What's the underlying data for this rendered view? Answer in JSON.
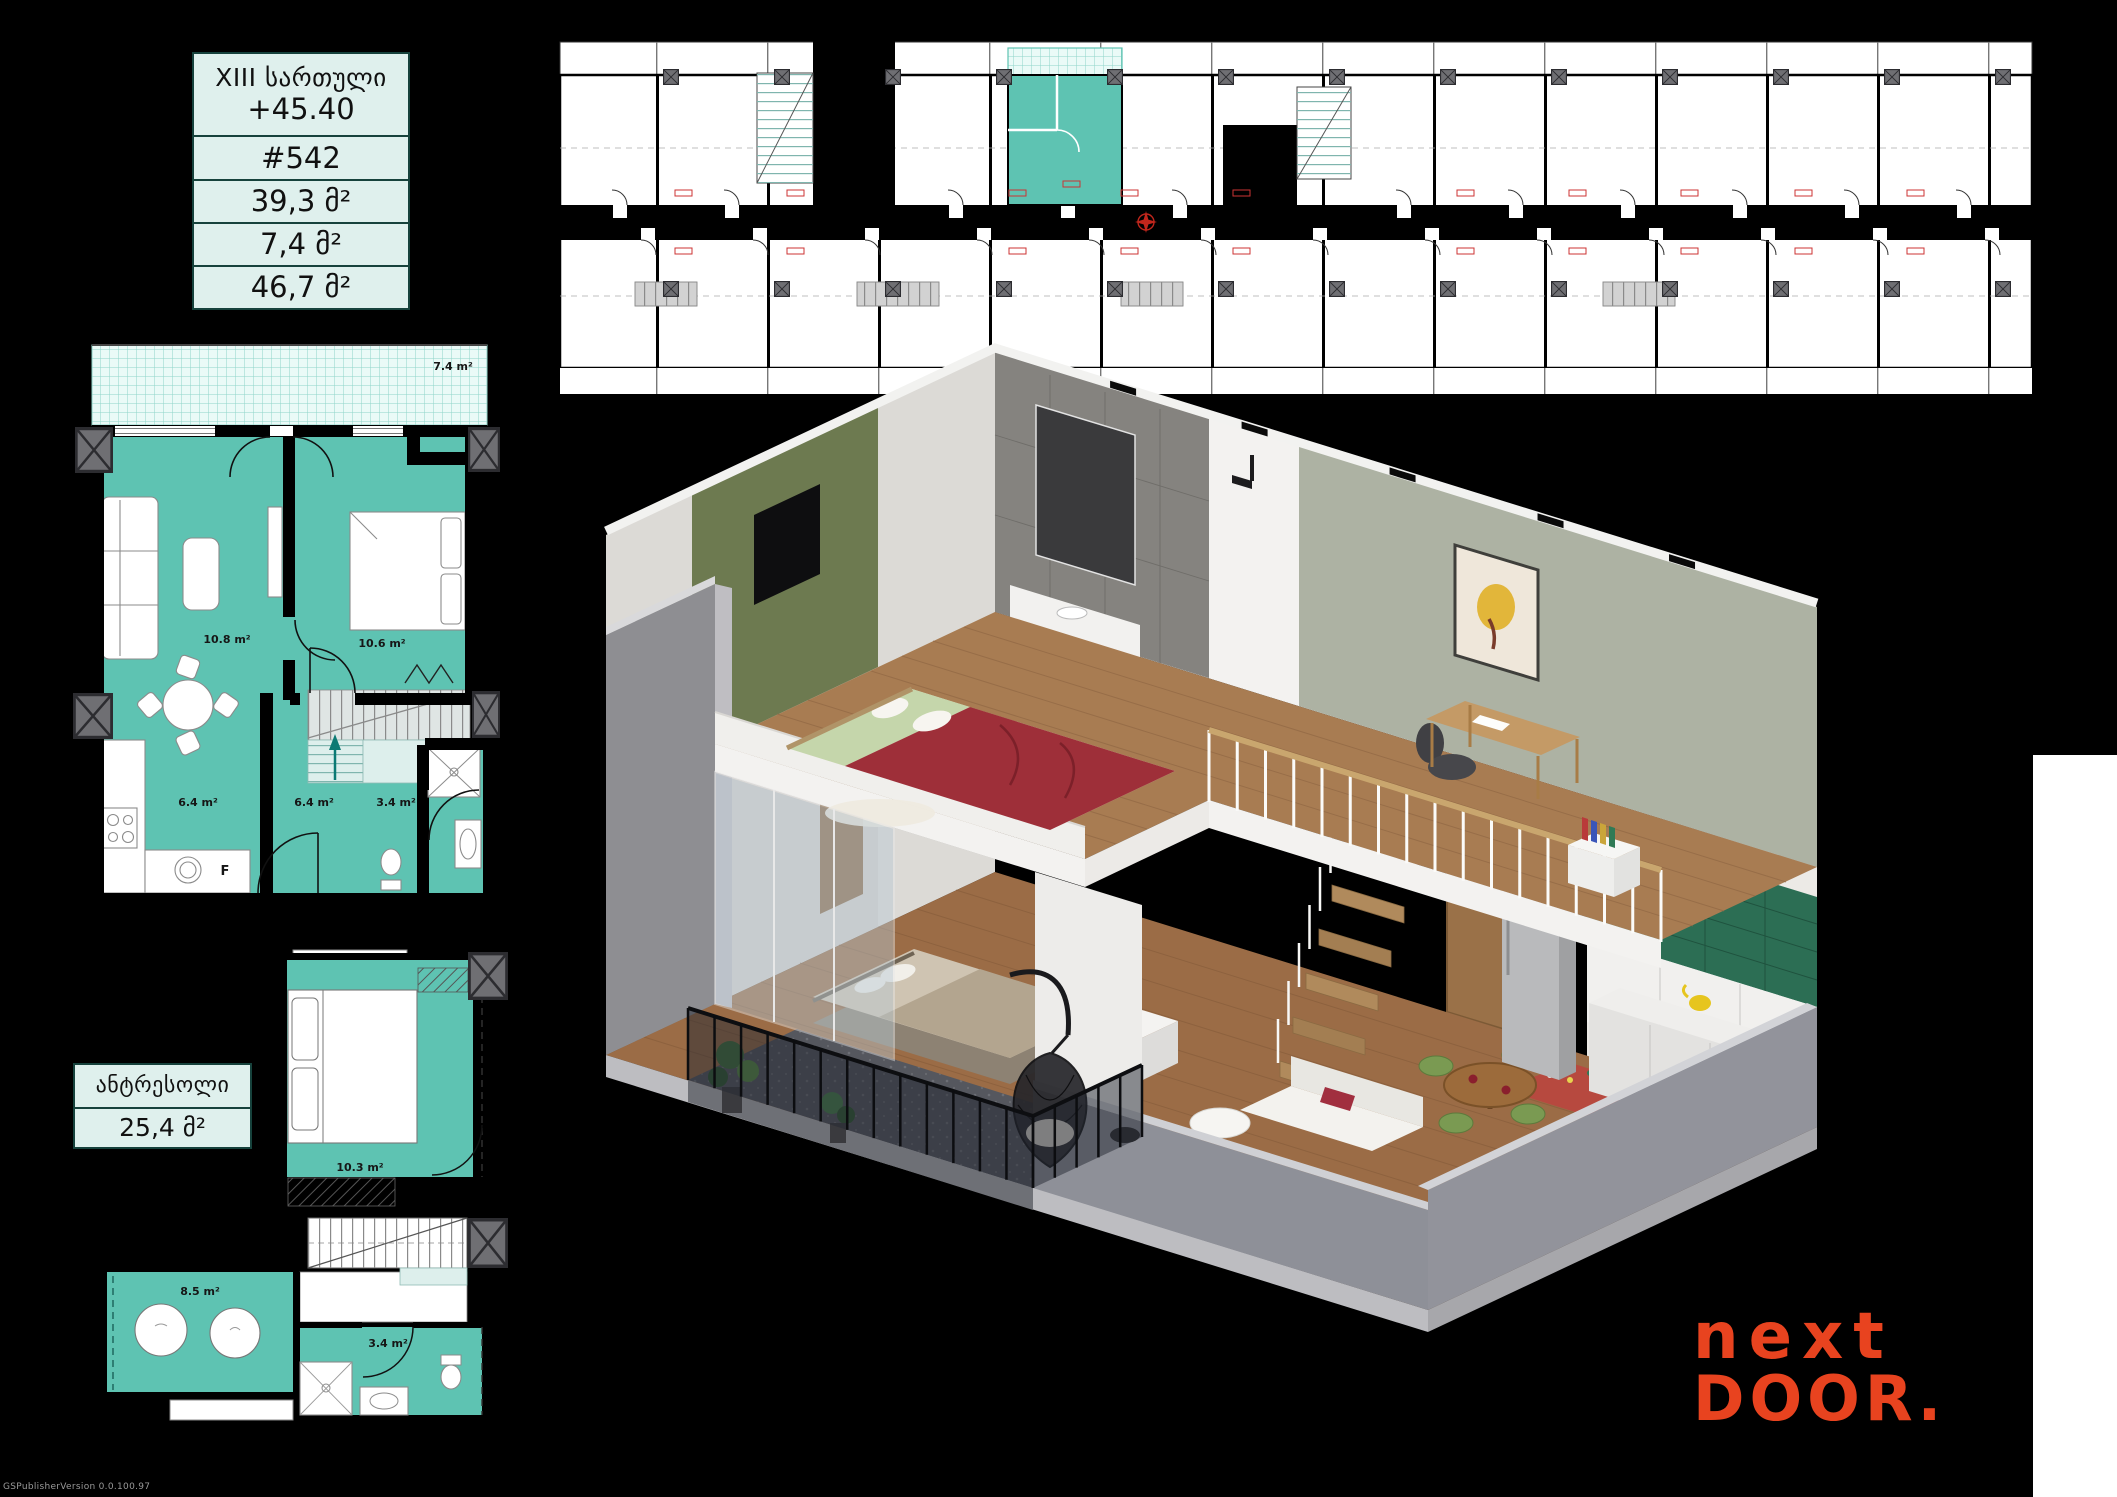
{
  "page": {
    "bg": "#000000",
    "watermark": "GSPublisherVersion 0.0.100.97"
  },
  "colors": {
    "teal": "#5ec3b2",
    "teal_light": "#ddefec",
    "table_bg": "#dff0ed",
    "table_border": "#16423c",
    "logo_orange": "#e8431f",
    "plan_wall": "#000000",
    "column_gray": "#6f6f73"
  },
  "info_table": {
    "floor_label": "XIII სართული",
    "elevation": "+45.40",
    "apartment_number": "#542",
    "area_main": "39,3 მ²",
    "area_balcony": "7,4 მ²",
    "area_total": "46,7 მ²"
  },
  "mezzanine_table": {
    "title": "ანტრესოლი",
    "area": "25,4 მ²"
  },
  "main_plan": {
    "balcony_area": "7.4 m²",
    "living_area": "10.8 m²",
    "bedroom_area": "10.6 m²",
    "kitchen_area": "6.4 m²",
    "hall_area": "6.4 m²",
    "bath_area": "3.4 m²",
    "sink_label": "F"
  },
  "mezzanine_plan": {
    "bedroom_area": "10.3 m²",
    "lounge_area": "8.5 m²",
    "bath_area": "3.4 m²"
  },
  "logo": {
    "line1": "next",
    "line2": "DOOR",
    "dot": "."
  }
}
